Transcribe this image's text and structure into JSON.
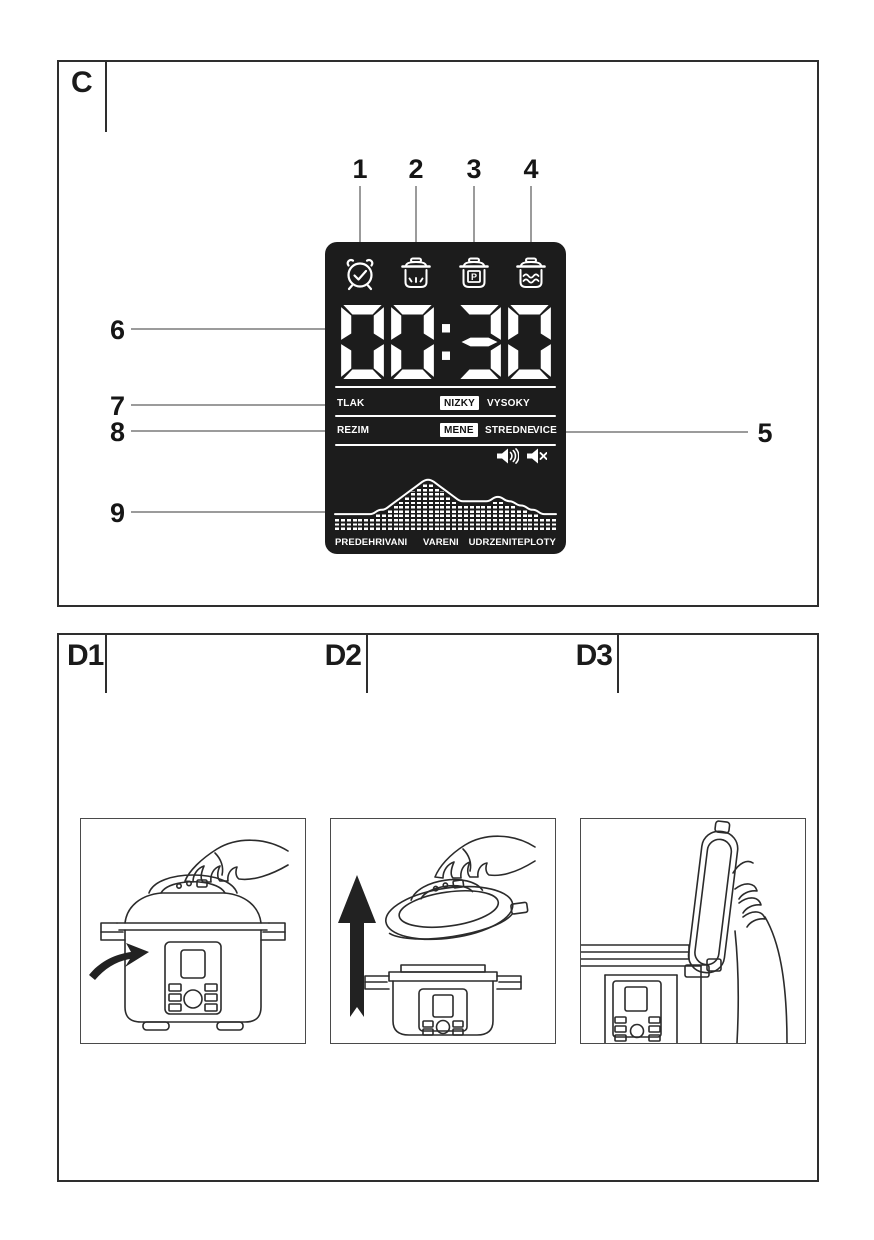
{
  "panel_c": {
    "label": "C",
    "callouts": {
      "top": [
        "1",
        "2",
        "3",
        "4"
      ],
      "left": [
        "6",
        "7",
        "8",
        "9"
      ],
      "right": [
        "5"
      ]
    },
    "display": {
      "time": "00:30",
      "icons": [
        "alarm-clock-timer",
        "pot-keep-warm",
        "pot-pressure-program",
        "pot-steam"
      ],
      "icon_p_label": "P",
      "pressure_row": {
        "label": "TLAK",
        "selected": "NIZKY",
        "option2": "VYSOKY"
      },
      "mode_row": {
        "label": "REZIM",
        "selected": "MENE",
        "option2": "STREDNE",
        "option3": "VICE"
      },
      "sound_icons": [
        "volume-on",
        "volume-muted"
      ],
      "phases": {
        "left": "PREDEHRIVANI",
        "center": "VARENI",
        "right": "UDRZENITEPLOTY"
      }
    }
  },
  "panel_d": {
    "labels": {
      "d1": "D1",
      "d2": "D2",
      "d3": "D3"
    }
  },
  "chart_data": {
    "type": "area",
    "title": "cooking phase temperature profile shown as segment bars",
    "x_labels": [
      "PREDEHRIVANI",
      "VARENI",
      "UDRZENITEPLOTY"
    ],
    "values": [
      3,
      3,
      3,
      3,
      3,
      3,
      3,
      4,
      4,
      5,
      6,
      7,
      8,
      9,
      10,
      11,
      11,
      10,
      9,
      8,
      7,
      6,
      6,
      6,
      6,
      6,
      6,
      7,
      7,
      6,
      6,
      5,
      5,
      4,
      4,
      3,
      3,
      3
    ],
    "ylim": [
      0,
      11
    ],
    "grid": false,
    "legend": "none"
  },
  "colors": {
    "display_bg": "#1c1c1c",
    "display_fg": "#ffffff",
    "leader_line": "#9b9b9b",
    "ink": "#1a1a1a"
  }
}
